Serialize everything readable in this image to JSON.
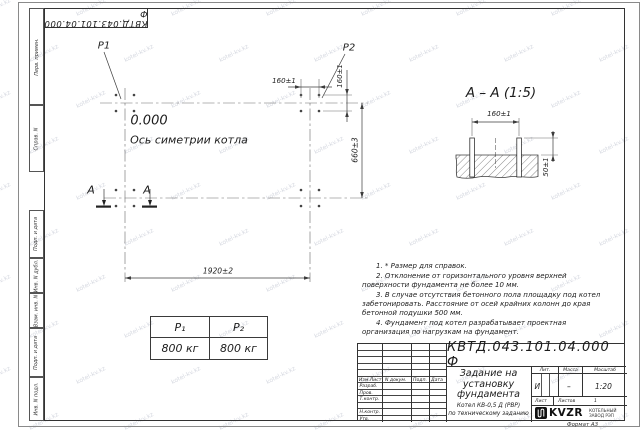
{
  "watermark": "kotel-kv.kz",
  "stamp": {
    "designation": "КВТД.043.101.04.000 Ф"
  },
  "margin_labels": {
    "top": [
      "Перв. примен.",
      "Справ. N"
    ],
    "bottom": [
      "Подп. и дата",
      "Инв. N дубл.",
      "Взам. инв. N",
      "Подп. и дата",
      "Инв. N подл."
    ]
  },
  "plan": {
    "p1": "P1",
    "p2": "P2",
    "elevation": "0.000",
    "axis_caption": "Ось симетрии котла",
    "dim_bolt_spacing_h": "160±1",
    "dim_bolt_spacing_v": "160±1",
    "dim_width": "660±3",
    "dim_length": "1920±2",
    "section_mark": "А"
  },
  "section": {
    "title": "А – А (1:5)",
    "dim_bolt_spacing": "160±1",
    "dim_protrusion": "50±1"
  },
  "load_table": {
    "col1_header": "P₁",
    "col2_header": "P₂",
    "col1_value": "800 кг",
    "col2_value": "800 кг"
  },
  "notes": {
    "items": [
      "1. * Размер для справок.",
      "2. Отклонение от горизонтального уровня верхней поверхности фундамента не более 10 мм.",
      "3. В случае отсутствия бетонного пола площадку под котел забетонировать. Расстояние от осей крайних колонн до края бетонной подушки 500 мм.",
      "4. Фундамент под котел разрабатывает проектная организация по нагрузкам на фундамент."
    ]
  },
  "title_block": {
    "designation": "КВТД.043.101.04.000 Ф",
    "title_lines": [
      "Задание на",
      "установку",
      "фундамента"
    ],
    "subject_lines": [
      "Котел КВ-0,5 Д (РВР)",
      "по техническому заданию"
    ],
    "rev_header": {
      "col1": "Изм.Лист",
      "col2": "N докум.",
      "col3": "Подп.",
      "col4": "Дата"
    },
    "roles": [
      "Разраб.",
      "Пров.",
      "Т.контр.",
      "",
      "Н.контр.",
      "Утв."
    ],
    "props_header": [
      "Лит.",
      "Масса",
      "Масштаб"
    ],
    "lit_value": "И",
    "mass_value": "–",
    "scale_value": "1:20",
    "sheet_label": "Лист",
    "sheets_label": "Листов",
    "sheets_value": "1",
    "logo_text": "KVZR",
    "company_lines": [
      "КОТЕЛЬНЫЙ",
      "ЗАВОД РЭП"
    ],
    "format_label": "Формат А3"
  }
}
